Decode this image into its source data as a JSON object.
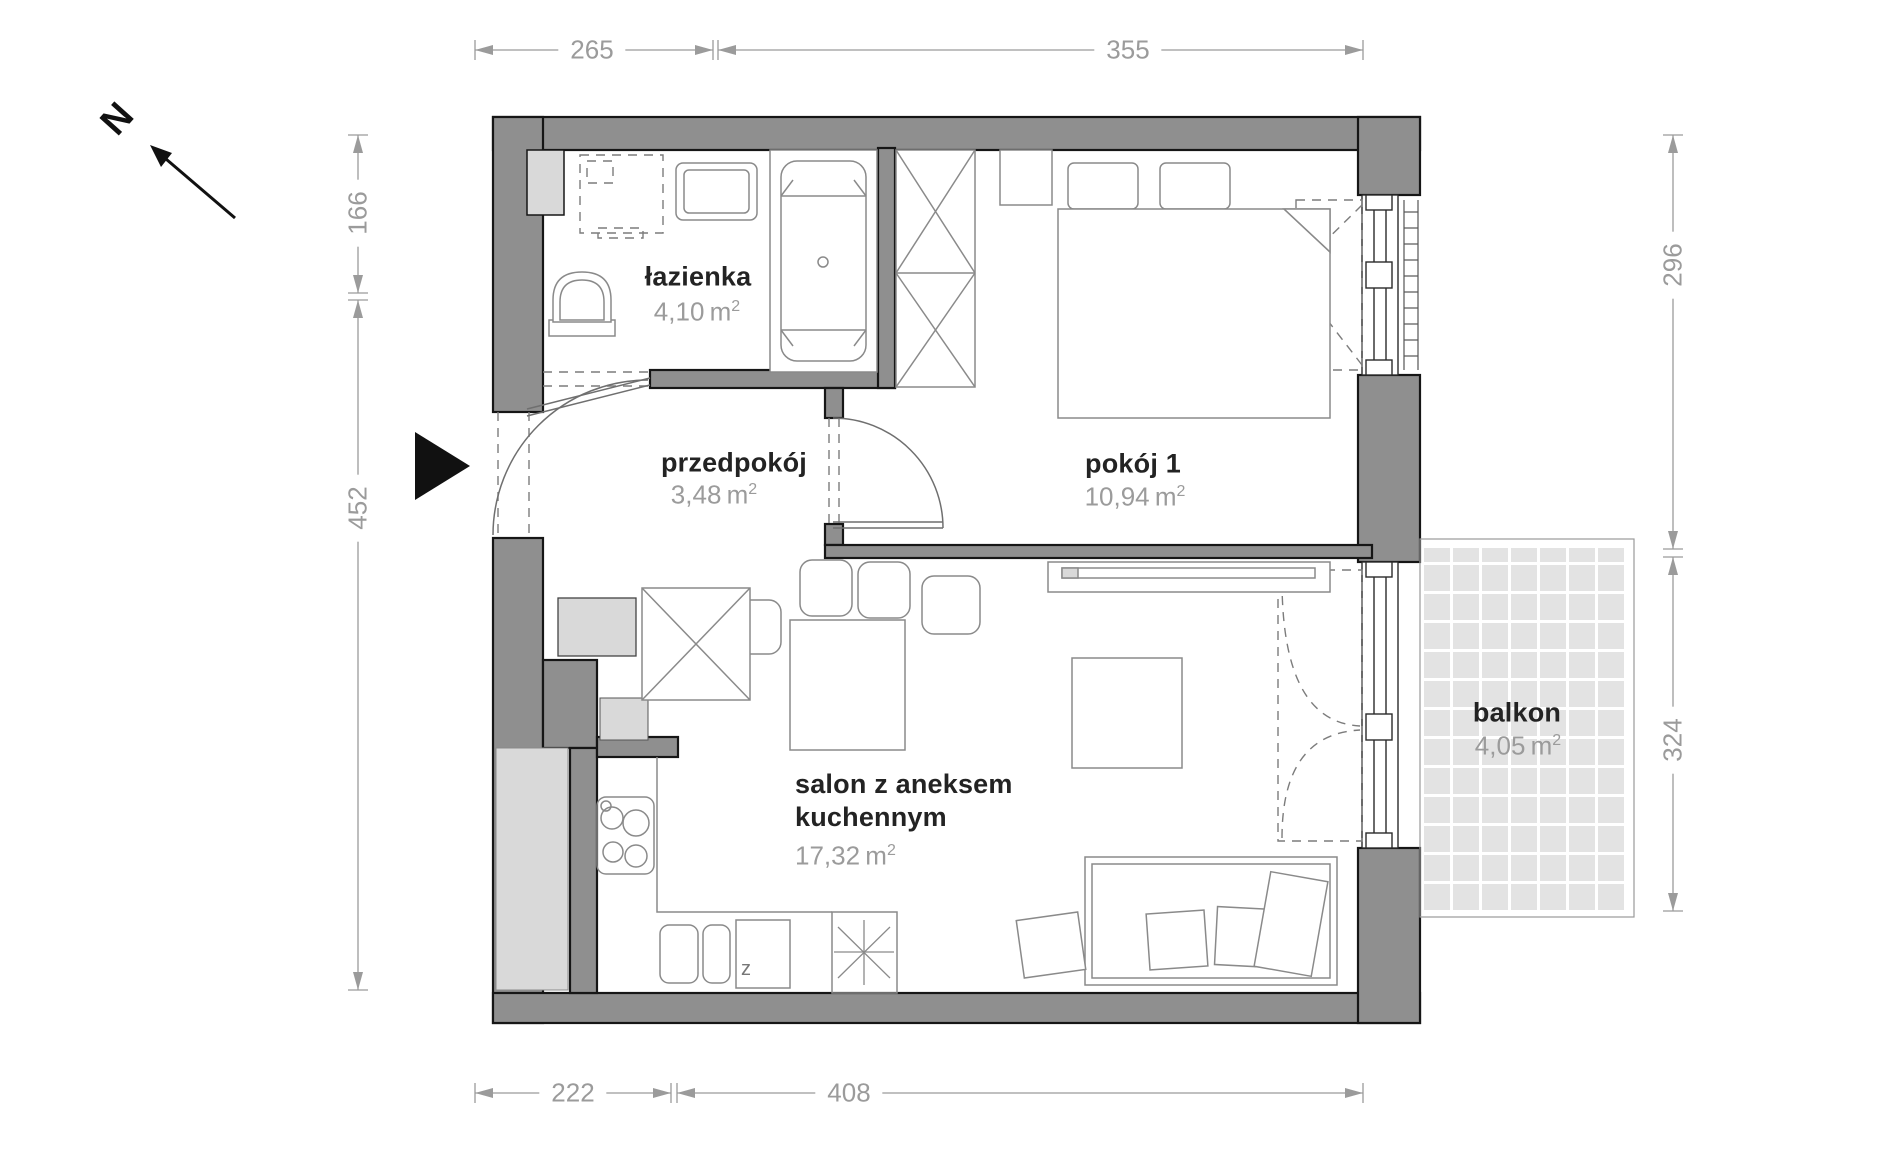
{
  "plan": {
    "north_label": "N",
    "area_unit": "m",
    "area_exponent": "2",
    "rooms": [
      {
        "id": "lazienka",
        "name": "łazienka",
        "area": "4,10"
      },
      {
        "id": "przedpokoj",
        "name": "przedpokój",
        "area": "3,48"
      },
      {
        "id": "pokoj1",
        "name": "pokój 1",
        "area": "10,94"
      },
      {
        "id": "salon",
        "name_line1": "salon z aneksem",
        "name_line2": "kuchennym",
        "area": "17,32"
      },
      {
        "id": "balkon",
        "name": "balkon",
        "area": "4,05"
      }
    ],
    "dimensions": {
      "top": [
        "265",
        "355"
      ],
      "bottom": [
        "222",
        "408"
      ],
      "left": [
        "166",
        "452"
      ],
      "right": [
        "296",
        "324"
      ]
    },
    "labels": {
      "dishwasher": "z"
    }
  }
}
